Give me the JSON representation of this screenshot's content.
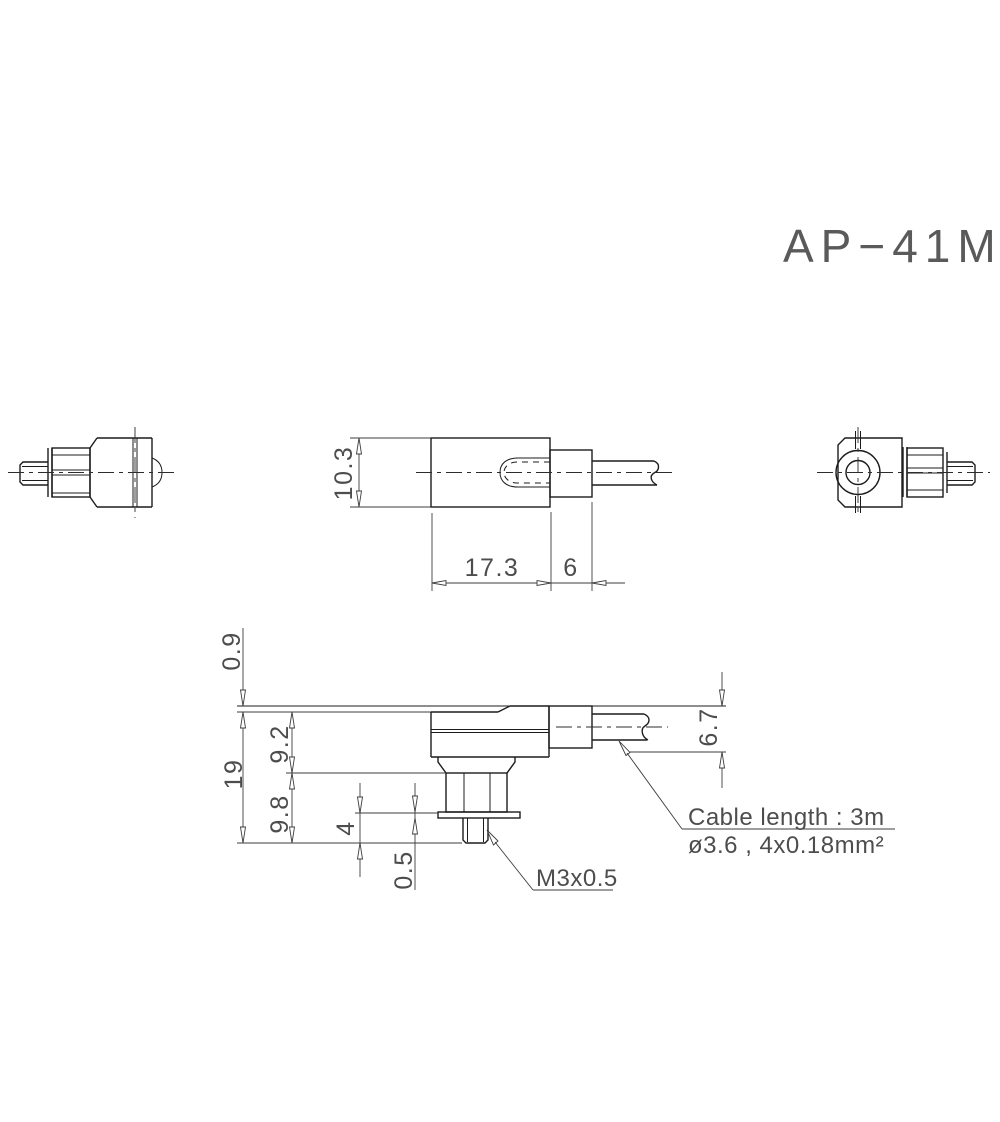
{
  "drawing": {
    "title": "AP−41M"
  },
  "dimensions": {
    "side_view": {
      "height": "10.3",
      "body_length": "17.3",
      "bushing_length": "6"
    },
    "mounted_view": {
      "surface_offset": "0.9",
      "overall_height": "19",
      "upper_height": "9.2",
      "lower_height": "9.8",
      "stud_length": "4",
      "washer_thickness": "0.5",
      "cable_offset": "6.7"
    }
  },
  "annotations": {
    "cable_length": "Cable length : 3m",
    "cable_spec": "ø3.6 , 4x0.18mm²",
    "thread_spec": "M3x0.5"
  }
}
